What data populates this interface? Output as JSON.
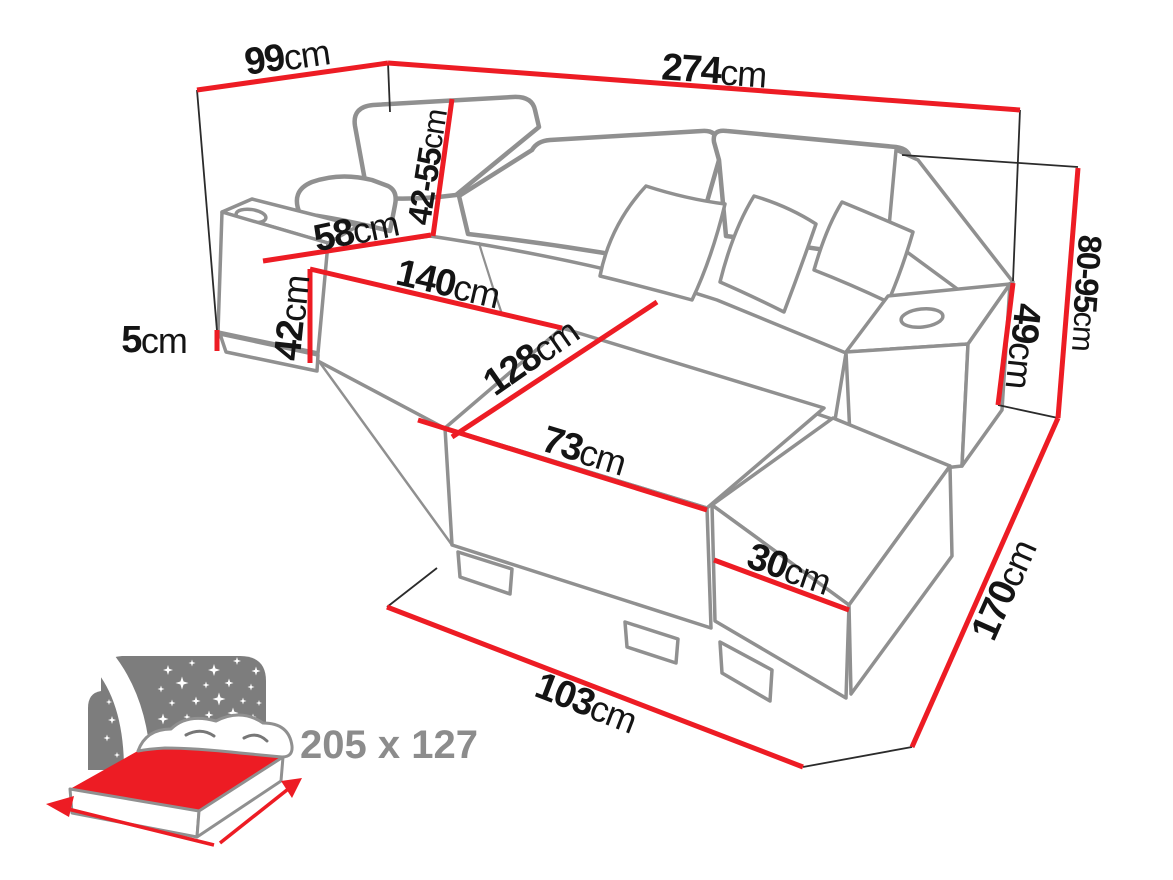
{
  "diagram": {
    "title": "corner-sofa-dimension-diagram",
    "background": "#ffffff"
  },
  "colors": {
    "dimension_red": "#ed1c24",
    "outline_gray": "#909090",
    "thin_line": "#2b2b2b",
    "label_black": "#141414",
    "icon_gray": "#7d7d7d",
    "icon_text_gray": "#8c8c8c",
    "fold_gray": "#777777"
  },
  "dimensions": {
    "back_width_left": {
      "value": "99",
      "unit": "cm"
    },
    "back_width_total": {
      "value": "274",
      "unit": "cm"
    },
    "headrest_height": {
      "value": "42-55",
      "unit": "cm"
    },
    "seat_depth": {
      "value": "58",
      "unit": "cm"
    },
    "seat_front_length": {
      "value": "140",
      "unit": "cm"
    },
    "seat_height": {
      "value": "42",
      "unit": "cm"
    },
    "leg_height": {
      "value": "5",
      "unit": "cm"
    },
    "chaise_length": {
      "value": "128",
      "unit": "cm"
    },
    "chaise_width": {
      "value": "73",
      "unit": "cm"
    },
    "ottoman_height": {
      "value": "30",
      "unit": "cm"
    },
    "front_width": {
      "value": "103",
      "unit": "cm"
    },
    "side_depth": {
      "value": "170",
      "unit": "cm"
    },
    "back_height": {
      "value": "80-95",
      "unit": "cm"
    },
    "armrest_height": {
      "value": "49",
      "unit": "cm"
    }
  },
  "sleep_function": {
    "icon": "bed-with-night-sky-icon",
    "dimensions_label": "205 x 127"
  }
}
